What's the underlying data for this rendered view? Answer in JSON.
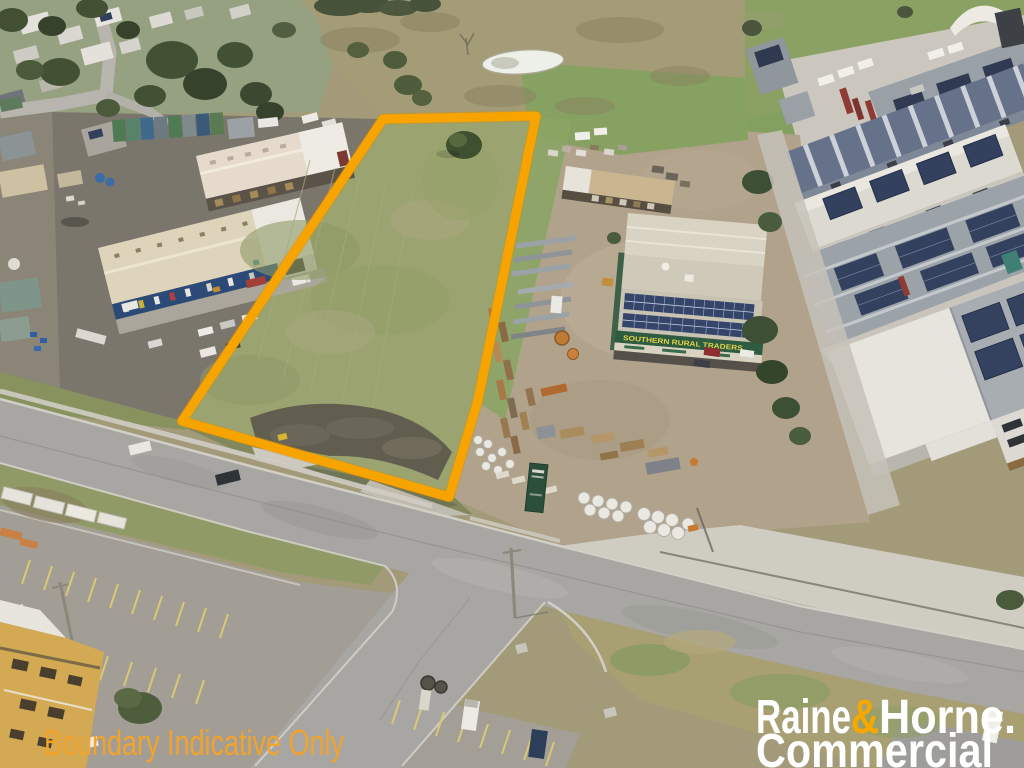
{
  "meta": {
    "type": "aerial-drone-photograph",
    "subject": "Vacant commercial land parcel outlined in orange within an industrial precinct, real-estate listing photo"
  },
  "overlay": {
    "disclaimer": "Boundary Indicative Only",
    "disclaimer_color": "#F2A32B"
  },
  "brand": {
    "raine": "Raine",
    "amp": "&",
    "horne": "Horne.",
    "commercial": "Commercial",
    "text_color": "#FFFFFF",
    "amp_color": "#F6A800"
  },
  "boundary": {
    "color": "#F7A400"
  },
  "signs": {
    "rural_traders": "SOUTHERN RURAL TRADERS"
  },
  "scene": {
    "features": [
      "vacant grass lot outlined in orange",
      "Southern Rural Traders yard with timber and steel stacks",
      "industrial warehouses with rooftop solar panels",
      "residential area with trees (top left)",
      "farm dam in brown paddock (top centre)",
      "road intersection with grass verges",
      "parking lots with yellow line marking",
      "stacked concrete pipes near road frontage"
    ]
  }
}
